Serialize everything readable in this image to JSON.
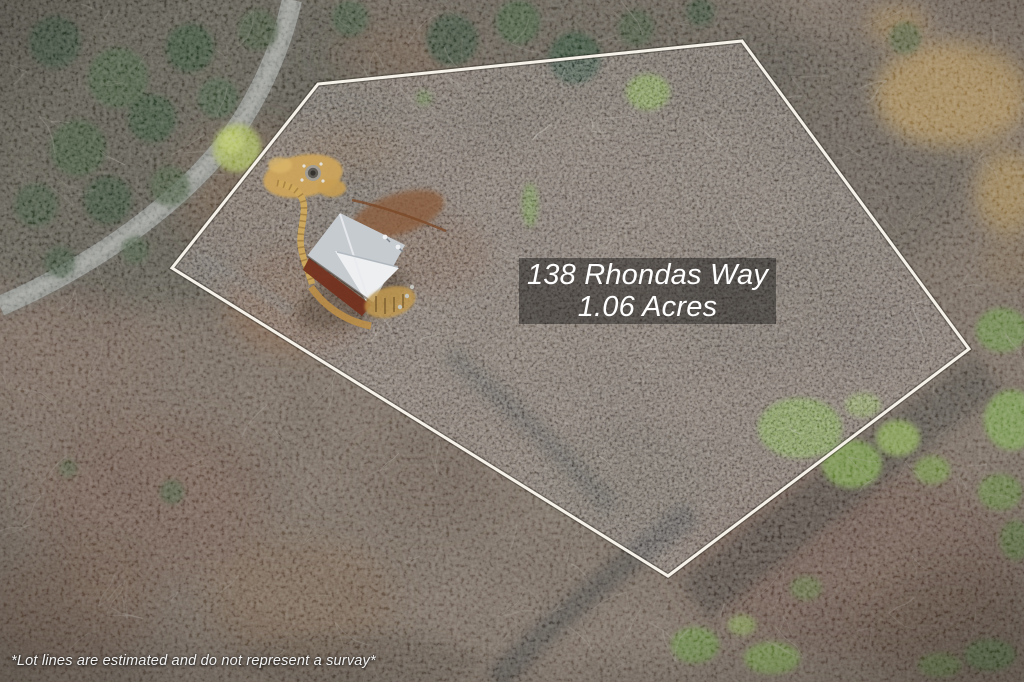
{
  "image": {
    "overlay": {
      "address": "138 Rhondas Way",
      "acreage": "1.06 Acres"
    },
    "disclaimer": "*Lot lines are estimated and do not represent a survay*",
    "lot": {
      "points": "742,41 318,84 172,268 668,576 969,349",
      "line_color": "#f6f2ea"
    },
    "colors": {
      "forest_base": "#6f6152",
      "lot_interior_tint": "#8d7d69",
      "conifer_green": "#34482c",
      "spring_green": "#7d9d40",
      "road_gray": "#84867f",
      "driveway_tan": "#cda55c",
      "house_roof": "#c6cbd0",
      "house_roof_highlight": "#edeff1",
      "house_wall": "#74311f",
      "dirt_tan": "#a3834a",
      "label_text": "#ffffff",
      "label_box_bg": "#080808"
    }
  }
}
